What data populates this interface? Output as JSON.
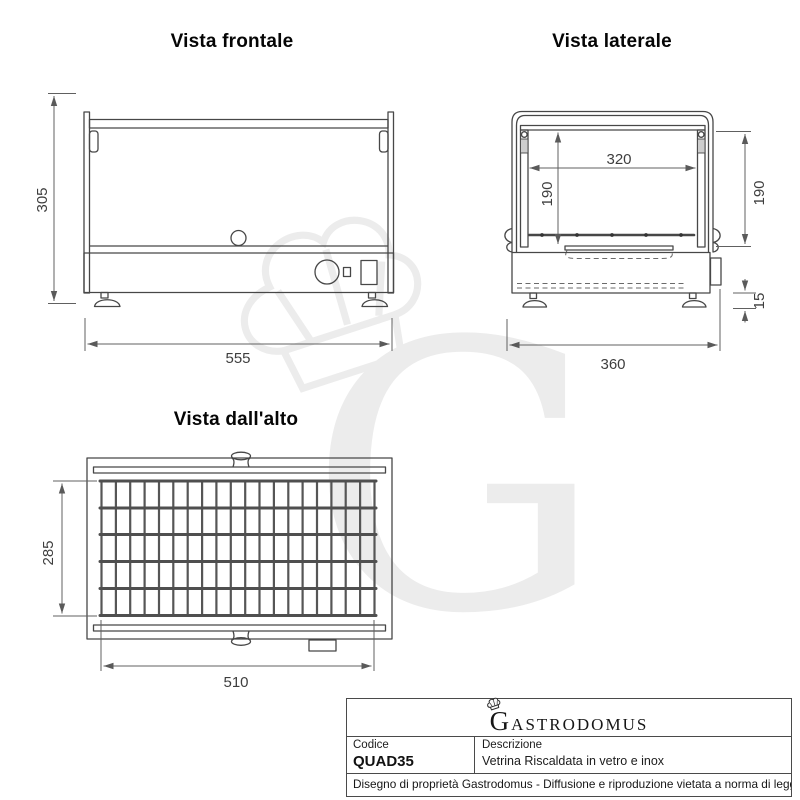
{
  "views": {
    "front": {
      "title": "Vista frontale",
      "dim_height": "305",
      "dim_width": "555"
    },
    "side": {
      "title": "Vista laterale",
      "dim_inner_width": "320",
      "dim_inner_height": "190",
      "dim_side_height": "190",
      "dim_base_clearance": "15",
      "dim_depth": "360"
    },
    "top": {
      "title": "Vista dall'alto",
      "dim_grid_depth": "285",
      "dim_grid_width": "510"
    }
  },
  "watermark": {
    "letter": "G"
  },
  "title_block": {
    "brand": "Gastrodomus",
    "code_label": "Codice",
    "code_value": "QUAD35",
    "description_label": "Descrizione",
    "description_value": "Vetrina Riscaldata in vetro e inox",
    "footer": "Disegno di proprietà Gastrodomus - Diffusione e riproduzione vietata a norma di legge."
  },
  "colors": {
    "line": "#474747",
    "dimension": "#606060",
    "watermark": "#ececec"
  }
}
